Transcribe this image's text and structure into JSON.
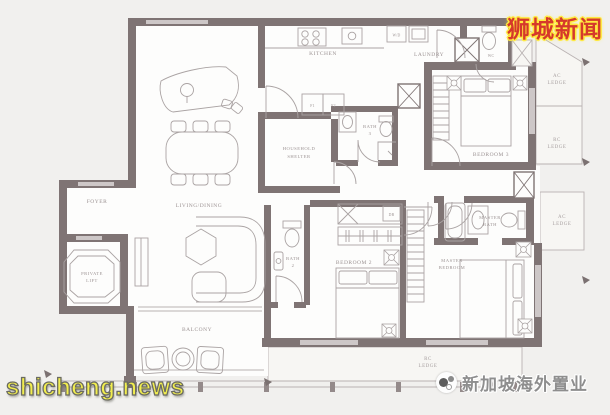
{
  "colors": {
    "background": "#f1f0ee",
    "wall": "#7f7474",
    "wall_window": "#cdc7c7",
    "furniture_line": "#aaa3a3",
    "label": "#9c9393",
    "watermark_red": "#d5392b",
    "watermark_glow_yellow": "#ffe93d",
    "watermark_yellow": "#f2ee4e",
    "watermark_gray": "#8e8e8e"
  },
  "watermarks": {
    "top_right": "狮城新闻",
    "bottom_left": "shicheng.news",
    "bottom_right": "新加坡海外置业"
  },
  "plan": {
    "labels": {
      "foyer": "FOYER",
      "private_lift_l1": "PRIVATE",
      "private_lift_l2": "LIFT",
      "living_dining": "LIVING/DINING",
      "balcony": "BALCONY",
      "kitchen": "KITCHEN",
      "laundry": "LAUNDRY",
      "wc": "WC",
      "household_shelter_l1": "HOUSEHOLD",
      "household_shelter_l2": "SHELTER",
      "bath": "BATH",
      "bath2_num": "2",
      "bath3_num": "3",
      "bedroom2": "BEDROOM 2",
      "bedroom3": "BEDROOM 3",
      "master": "MASTER",
      "bedroom": "BEDROOM",
      "master_bath_l2": "BATH",
      "ac": "AC",
      "rc": "RC",
      "ledge": "LEDGE",
      "f1": "F1",
      "f2": "F2",
      "db": "DB",
      "wd": "W/D"
    }
  }
}
